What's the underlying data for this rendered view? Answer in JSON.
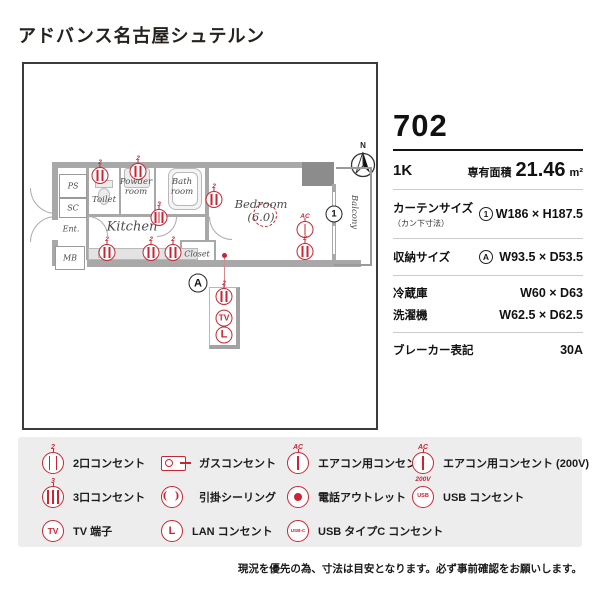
{
  "title": "アドバンス名古屋シュテルン",
  "accent_color": "#c82633",
  "compass": {
    "north_label": "N"
  },
  "floorplan": {
    "rooms": {
      "ps": "PS",
      "sc": "SC",
      "ent": "Ent.",
      "mb": "MB",
      "toilet": "Toilet",
      "powder_line1": "Powder",
      "powder_line2": "room",
      "bath_line1": "Bath",
      "bath_line2": "room",
      "kitchen": "Kitchen",
      "closet": "Closet",
      "bedroom_line1": "Bedroom",
      "bedroom_line2": "(6.0)",
      "balcony": "Balcony"
    },
    "markers": {
      "curtain": "1",
      "storage": "A"
    }
  },
  "icons": {
    "outlet2_sup": "2",
    "outlet3_sup": "3",
    "ac_label": "AC",
    "ac_200v_label": "200V",
    "tv_label": "TV",
    "lan_label": "L",
    "usb_label": "USB",
    "usbc_label": "USB-C",
    "ceiling_glyph": "( )"
  },
  "unit": {
    "number": "702",
    "layout": "1K",
    "area_label": "専有面積",
    "area_value": "21.46",
    "area_unit": "m²",
    "curtain_label": "カーテンサイズ",
    "curtain_sublabel": "（カン下寸法）",
    "curtain_value": "W186 × H187.5",
    "storage_label": "収納サイズ",
    "storage_value": "W93.5 × D53.5",
    "fridge_label": "冷蔵庫",
    "fridge_value": "W60 × D63",
    "washer_label": "洗濯機",
    "washer_value": "W62.5 × D62.5",
    "breaker_label": "ブレーカー表記",
    "breaker_value": "30A"
  },
  "legend": {
    "items": [
      {
        "label": "2口コンセント"
      },
      {
        "label": "ガスコンセント"
      },
      {
        "label": "エアコン用コンセント"
      },
      {
        "label": "エアコン用コンセント (200V)"
      },
      {
        "label": "3口コンセント"
      },
      {
        "label": "引掛シーリング"
      },
      {
        "label": "電話アウトレット"
      },
      {
        "label": "USB コンセント"
      },
      {
        "label": "TV 端子"
      },
      {
        "label": "LAN コンセント"
      },
      {
        "label": "USB タイプC コンセント"
      }
    ]
  },
  "note": "現況を優先の為、寸法は目安となります。必ず事前確認をお願いします。"
}
